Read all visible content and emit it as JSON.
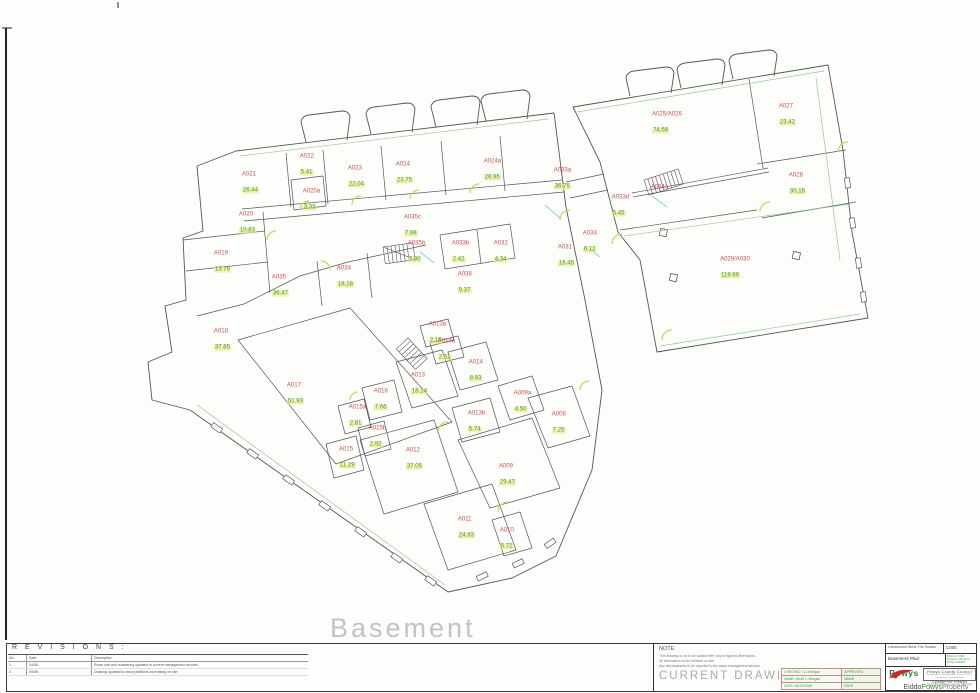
{
  "sheet": {
    "plan_title": "Basement",
    "revisions": {
      "title": "R E V I S I O N S :",
      "columns": {
        "no": "No:",
        "date": "Date",
        "desc": "Description:"
      },
      "rows": [
        {
          "no": "1",
          "date": "04/08",
          "desc": "Room use and numbering updated to current management records"
        },
        {
          "no": "2",
          "date": "09/08",
          "desc": "Drawing updated to show partitions as existing on site"
        }
      ]
    },
    "note": {
      "label": "NOTE:",
      "lines": [
        "This drawing is not to be scaled refer only to figured dimensions.",
        "All dimensions to be checked on site.",
        "Any discrepancies to be reported to the asset management section."
      ],
      "status": "CURRENT DRAWING"
    },
    "sign_table": {
      "rows": [
        {
          "left": "CHECKED: S.J.Morgan",
          "right": "APPROVED"
        },
        {
          "left": "NAME: Geoff L. Morgan",
          "right": "NAME"
        },
        {
          "left": "DATE: 08/10/2008",
          "right": "DATE"
        }
      ]
    },
    "title_block": {
      "project": "Llandrindod Wells The Gwalia",
      "sheet_no": "C005",
      "drawing_title": "Basement Plan",
      "meta_lines": [
        "DRG No: C005",
        "SCALE 1:100 @ A3",
        "DATE: 10/2008"
      ],
      "council_en": "Powys County Council",
      "council_addr": [
        "Neuadd y Sir, Llandrindod Wells, Powys LD1 5LG",
        "County Hall, Llandrindod Wells"
      ],
      "council_cy": "Cyngor Sir Powys",
      "dept_lines": [
        "Adfywio, Eiddo a Chomisiynu",
        "Regeneration, Property and Commissioning"
      ],
      "logo_word": "Powys",
      "brand": {
        "part1": "Eiddo",
        "part2": "Powys",
        "part3": "Property"
      }
    },
    "colors": {
      "room_code": "#cc5050",
      "room_area": "#3a9a3a",
      "highlight": "#ecec8c",
      "walls": "#55555c",
      "accent_green": "#7cc47c",
      "accent_yellow": "#d6cf5e",
      "accent_cyan": "#49c8c8",
      "powys_red": "#c62828",
      "powys_green": "#2a7d32"
    }
  },
  "rooms": [
    {
      "code": "A021",
      "area": "26.44",
      "x": 247,
      "y": 184
    },
    {
      "code": "A022",
      "area": "5.41",
      "x": 304,
      "y": 166
    },
    {
      "code": "A023",
      "area": "22.04",
      "x": 353,
      "y": 178
    },
    {
      "code": "A020a",
      "area": "3.33",
      "x": 308,
      "y": 201
    },
    {
      "code": "A024",
      "area": "23.75",
      "x": 401,
      "y": 174
    },
    {
      "code": "A024a",
      "area": "26.95",
      "x": 489,
      "y": 171
    },
    {
      "code": "A033a",
      "area": "36.75",
      "x": 559,
      "y": 180
    },
    {
      "code": "A020",
      "area": "10.83",
      "x": 244,
      "y": 224
    },
    {
      "code": "A019",
      "area": "13.76",
      "x": 219,
      "y": 263
    },
    {
      "code": "A035c",
      "area": "7.98",
      "x": 409,
      "y": 227
    },
    {
      "code": "A035b",
      "area": "7.30",
      "x": 413,
      "y": 253
    },
    {
      "code": "A033b",
      "area": "2.42",
      "x": 457,
      "y": 253
    },
    {
      "code": "A032",
      "area": "4.34",
      "x": 498,
      "y": 253
    },
    {
      "code": "A031",
      "area": "16.45",
      "x": 563,
      "y": 257
    },
    {
      "code": "A033",
      "area": "6.12",
      "x": 587,
      "y": 243
    },
    {
      "code": "A033d",
      "area": "5.45",
      "x": 617,
      "y": 207
    },
    {
      "code": "A034a",
      "area": "",
      "x": 656,
      "y": 188
    },
    {
      "code": "A035",
      "area": "36.47",
      "x": 277,
      "y": 287
    },
    {
      "code": "A034",
      "area": "18.18",
      "x": 342,
      "y": 278
    },
    {
      "code": "A038",
      "area": "9.37",
      "x": 462,
      "y": 284
    },
    {
      "code": "A025/A026",
      "area": "74.56",
      "x": 661,
      "y": 124
    },
    {
      "code": "A027",
      "area": "23.42",
      "x": 784,
      "y": 116
    },
    {
      "code": "A028",
      "area": "30.16",
      "x": 794,
      "y": 185
    },
    {
      "code": "A029/A030",
      "area": "119.69",
      "x": 729,
      "y": 269
    },
    {
      "code": "A018",
      "area": "37.85",
      "x": 219,
      "y": 341
    },
    {
      "code": "A017",
      "area": "51.93",
      "x": 292,
      "y": 395
    },
    {
      "code": "A016",
      "area": "7.66",
      "x": 378,
      "y": 401
    },
    {
      "code": "A015a",
      "area": "2.81",
      "x": 354,
      "y": 417
    },
    {
      "code": "A015b",
      "area": "2.92",
      "x": 374,
      "y": 438
    },
    {
      "code": "A015",
      "area": "11.29",
      "x": 344,
      "y": 459
    },
    {
      "code": "A013",
      "area": "18.14",
      "x": 416,
      "y": 385
    },
    {
      "code": "A013a",
      "area": "2.16",
      "x": 434,
      "y": 334
    },
    {
      "code": "A014a",
      "area": "2.51",
      "x": 443,
      "y": 351
    },
    {
      "code": "A014",
      "area": "8.93",
      "x": 473,
      "y": 372
    },
    {
      "code": "A013b",
      "area": "5.74",
      "x": 473,
      "y": 423
    },
    {
      "code": "A012",
      "area": "37.05",
      "x": 411,
      "y": 460
    },
    {
      "code": "A009a",
      "area": "4.50",
      "x": 519,
      "y": 403
    },
    {
      "code": "A008",
      "area": "7.25",
      "x": 556,
      "y": 424
    },
    {
      "code": "A009",
      "area": "29.47",
      "x": 504,
      "y": 476
    },
    {
      "code": "A011",
      "area": "24.93",
      "x": 463,
      "y": 529
    },
    {
      "code": "A010",
      "area": "5.72",
      "x": 504,
      "y": 540
    }
  ]
}
